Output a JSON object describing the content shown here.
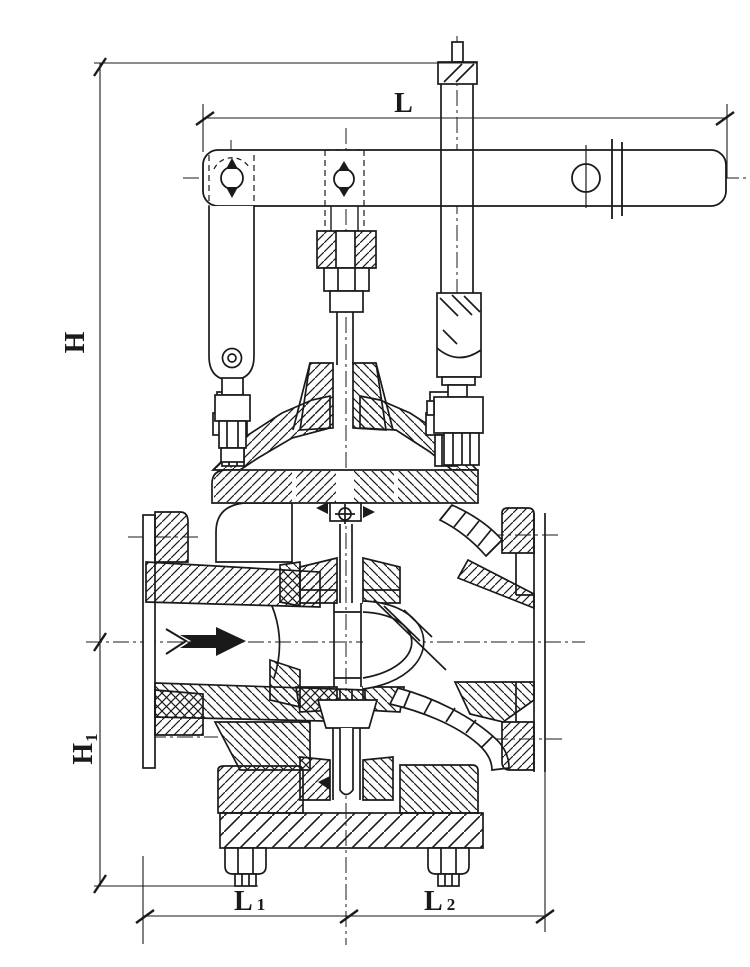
{
  "page": {
    "background": "#ffffff",
    "ink": "#1a1a1a"
  },
  "dimensions": {
    "L": {
      "text": "L"
    },
    "H": {
      "text": "H"
    },
    "H1": {
      "base": "H",
      "sub": "1"
    },
    "L1": {
      "base": "L",
      "sub": "1"
    },
    "L2": {
      "base": "L",
      "sub": "2"
    }
  },
  "icons": {
    "flow_arrow": "right-arrow"
  }
}
